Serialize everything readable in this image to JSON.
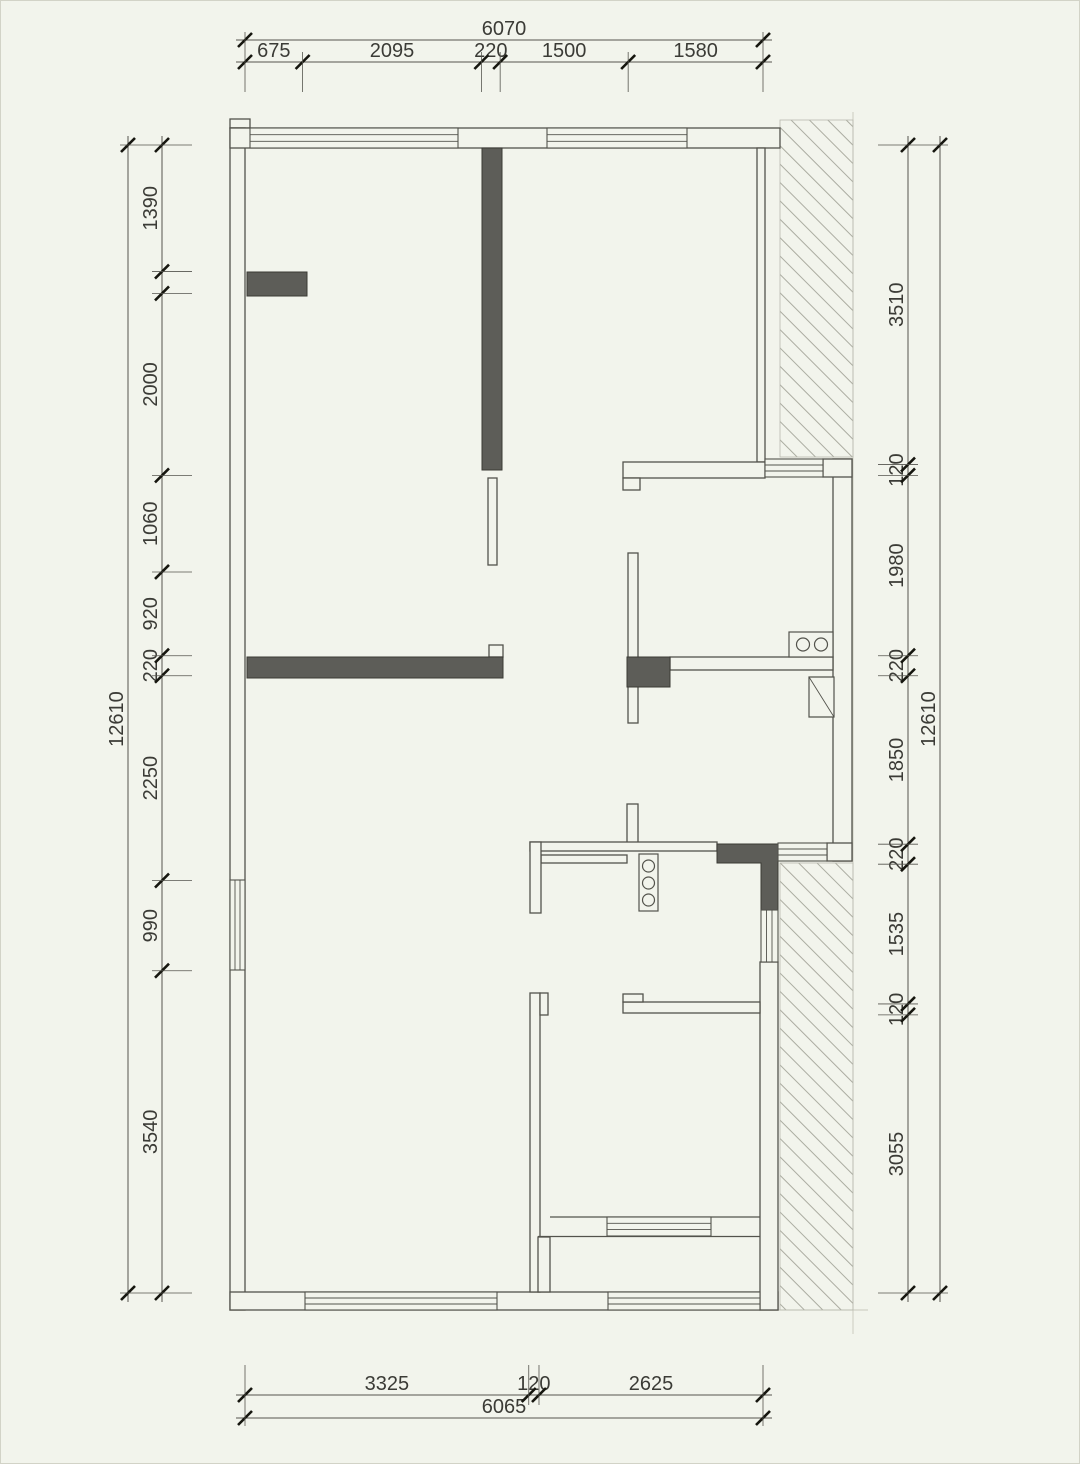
{
  "page": {
    "background": "#f2f4ec",
    "frame_color": "#d2d3c7"
  },
  "drawing": {
    "type": "residential-floor-plan",
    "colors": {
      "wall_line": "#53534c",
      "dark_fill": "#5d5d58",
      "hatch_line": "#abaca1",
      "dim_line": "#55554e",
      "tick": "#16160f",
      "text": "#3b3b36"
    },
    "symbols": [
      "cooktop-2-burner-icon",
      "basin-column-icon",
      "door-leaf-icon",
      "window-lines",
      "hatched-void"
    ]
  },
  "dimensions": {
    "top": {
      "total": "6070",
      "segments": [
        "675",
        "2095",
        "220",
        "1500",
        "1580"
      ]
    },
    "bottom": {
      "total": "6065",
      "segments": [
        "3325",
        "120",
        "2625"
      ]
    },
    "left": {
      "total": "12610",
      "segments": [
        "1390",
        "2000",
        "1060",
        "920",
        "220",
        "2250",
        "990",
        "3540"
      ]
    },
    "right": {
      "total": "12610",
      "segments": [
        "3510",
        "120",
        "1980",
        "220",
        "1850",
        "220",
        "1535",
        "120",
        "3055"
      ]
    }
  }
}
